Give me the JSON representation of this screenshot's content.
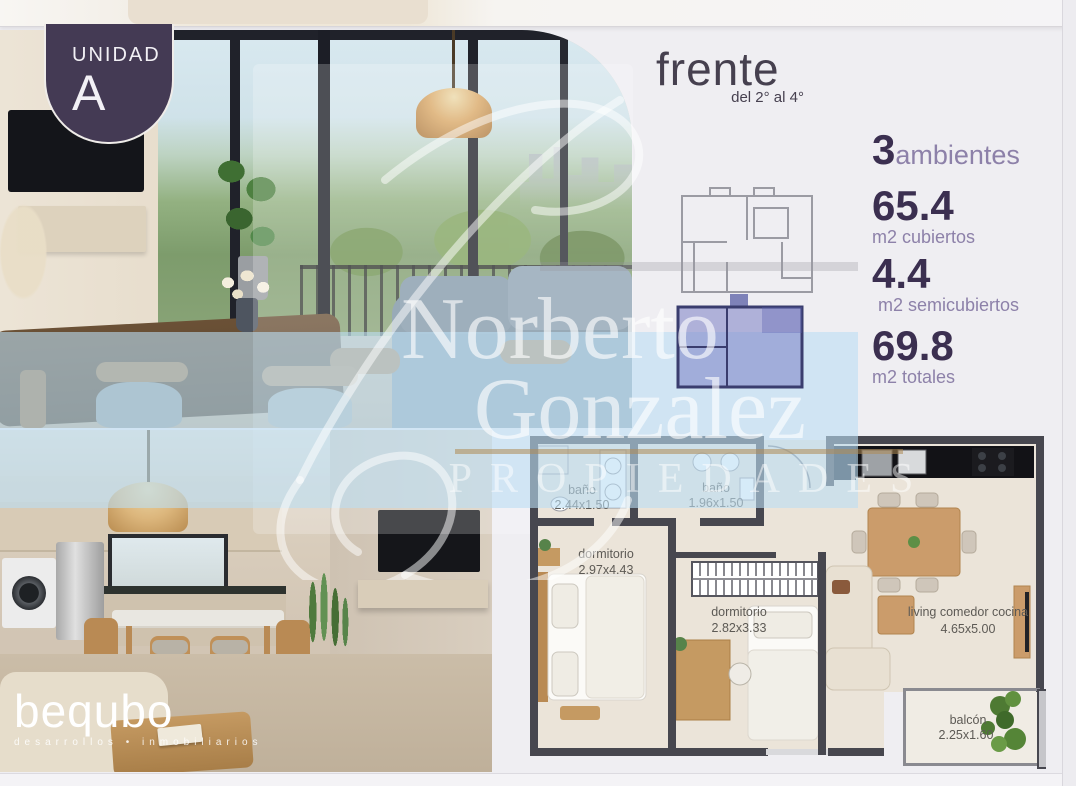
{
  "badge": {
    "label": "UNIDAD",
    "unit": "A"
  },
  "header": {
    "title": "frente",
    "subtitle": "del 2° al 4°"
  },
  "stats": {
    "rooms": {
      "value": "3",
      "label": "ambientes"
    },
    "items": [
      {
        "value": "65.4",
        "label": "m2 cubiertos"
      },
      {
        "value": "4.4",
        "label": "m2 semicubiertos"
      },
      {
        "value": "69.8",
        "label": "m2 totales"
      }
    ]
  },
  "watermark": {
    "line1": "Norberto",
    "line2": "Gonzalez",
    "line3": "PROPIEDADES"
  },
  "developer": {
    "name": "bequbo",
    "tagline": "desarrollos • inmobiliarios"
  },
  "floorplan": {
    "rooms": [
      {
        "name": "baño",
        "size": "2.44x1.50"
      },
      {
        "name": "baño",
        "size": "1.96x1.50"
      },
      {
        "name": "dormitorio",
        "size": "2.97x4.43"
      },
      {
        "name": "dormitorio",
        "size": "2.82x3.33"
      },
      {
        "name": "living comedor cocina",
        "size": "4.65x5.00"
      },
      {
        "name": "balcón",
        "size": "2.25x1.60"
      }
    ]
  },
  "colors": {
    "badge_purple": "#443a54",
    "stat_number": "#3b2f50",
    "stat_label": "#8d81a9",
    "watermark_band": "#cfe4f3",
    "keyplan_highlight": "#7a7fc5",
    "plan_wall": "#47474f",
    "plan_floor": "#ebe4d9"
  }
}
